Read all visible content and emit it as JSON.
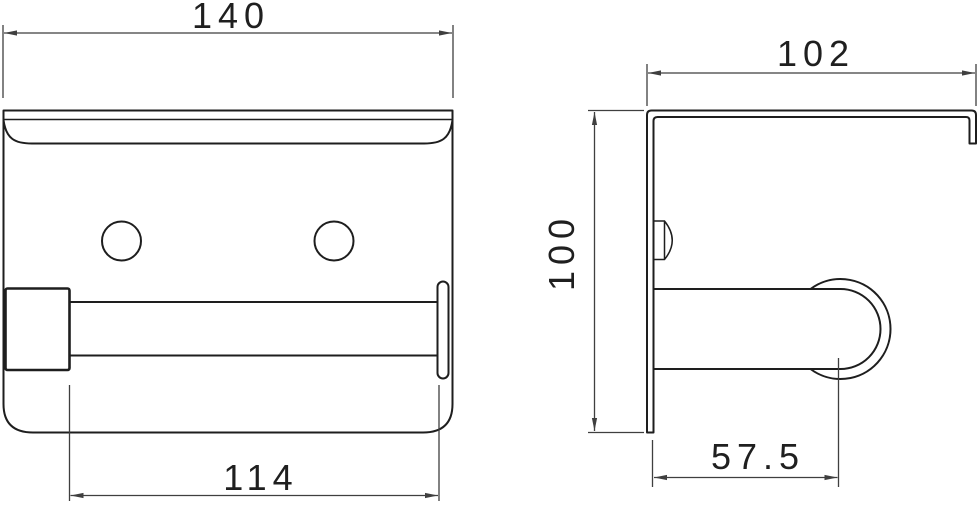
{
  "colors": {
    "outline": "#1e1e1e",
    "dimension": "#3f3f3f",
    "background": "#ffffff"
  },
  "dimensions": {
    "overall_width": "140",
    "roller_length": "114",
    "depth": "102",
    "height": "100",
    "roller_center_offset": "57.5"
  }
}
